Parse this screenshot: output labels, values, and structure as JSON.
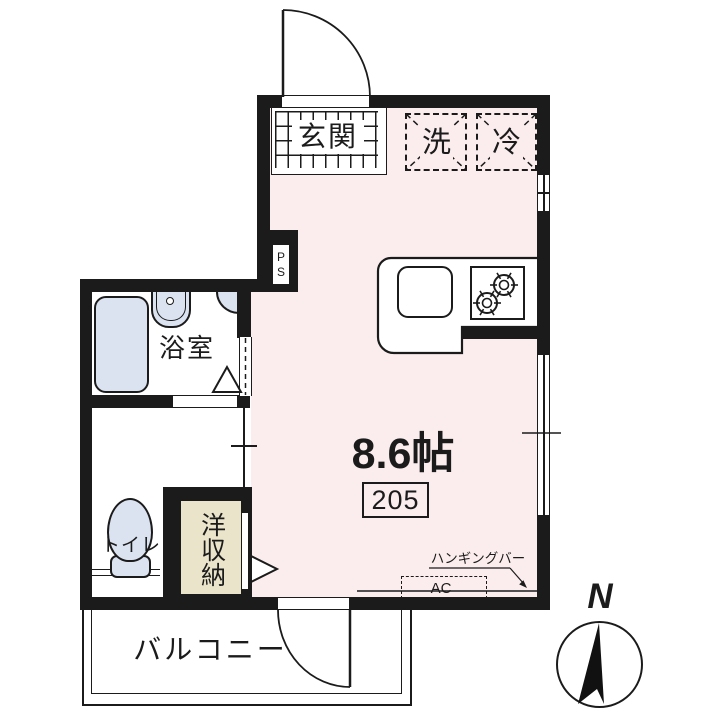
{
  "floorplan": {
    "entrance_label": "玄関",
    "washer_label": "洗",
    "fridge_label": "冷",
    "bathroom_label": "浴室",
    "toilet_label": "トイレ",
    "closet_label": "洋収納",
    "room_area_label": "8.6帖",
    "room_number": "205",
    "balcony_label": "バルコニー",
    "hanging_bar_label": "ハンギングバー",
    "ac_label": "AC",
    "pipe_space_label": "PS",
    "compass_north_label": "N"
  },
  "colors": {
    "wall": "#1b1b1b",
    "room_floor": "#fbedee",
    "fixture_blue": "#dbe3f1",
    "closet_beige": "#e9e4ca",
    "background": "#ffffff"
  }
}
